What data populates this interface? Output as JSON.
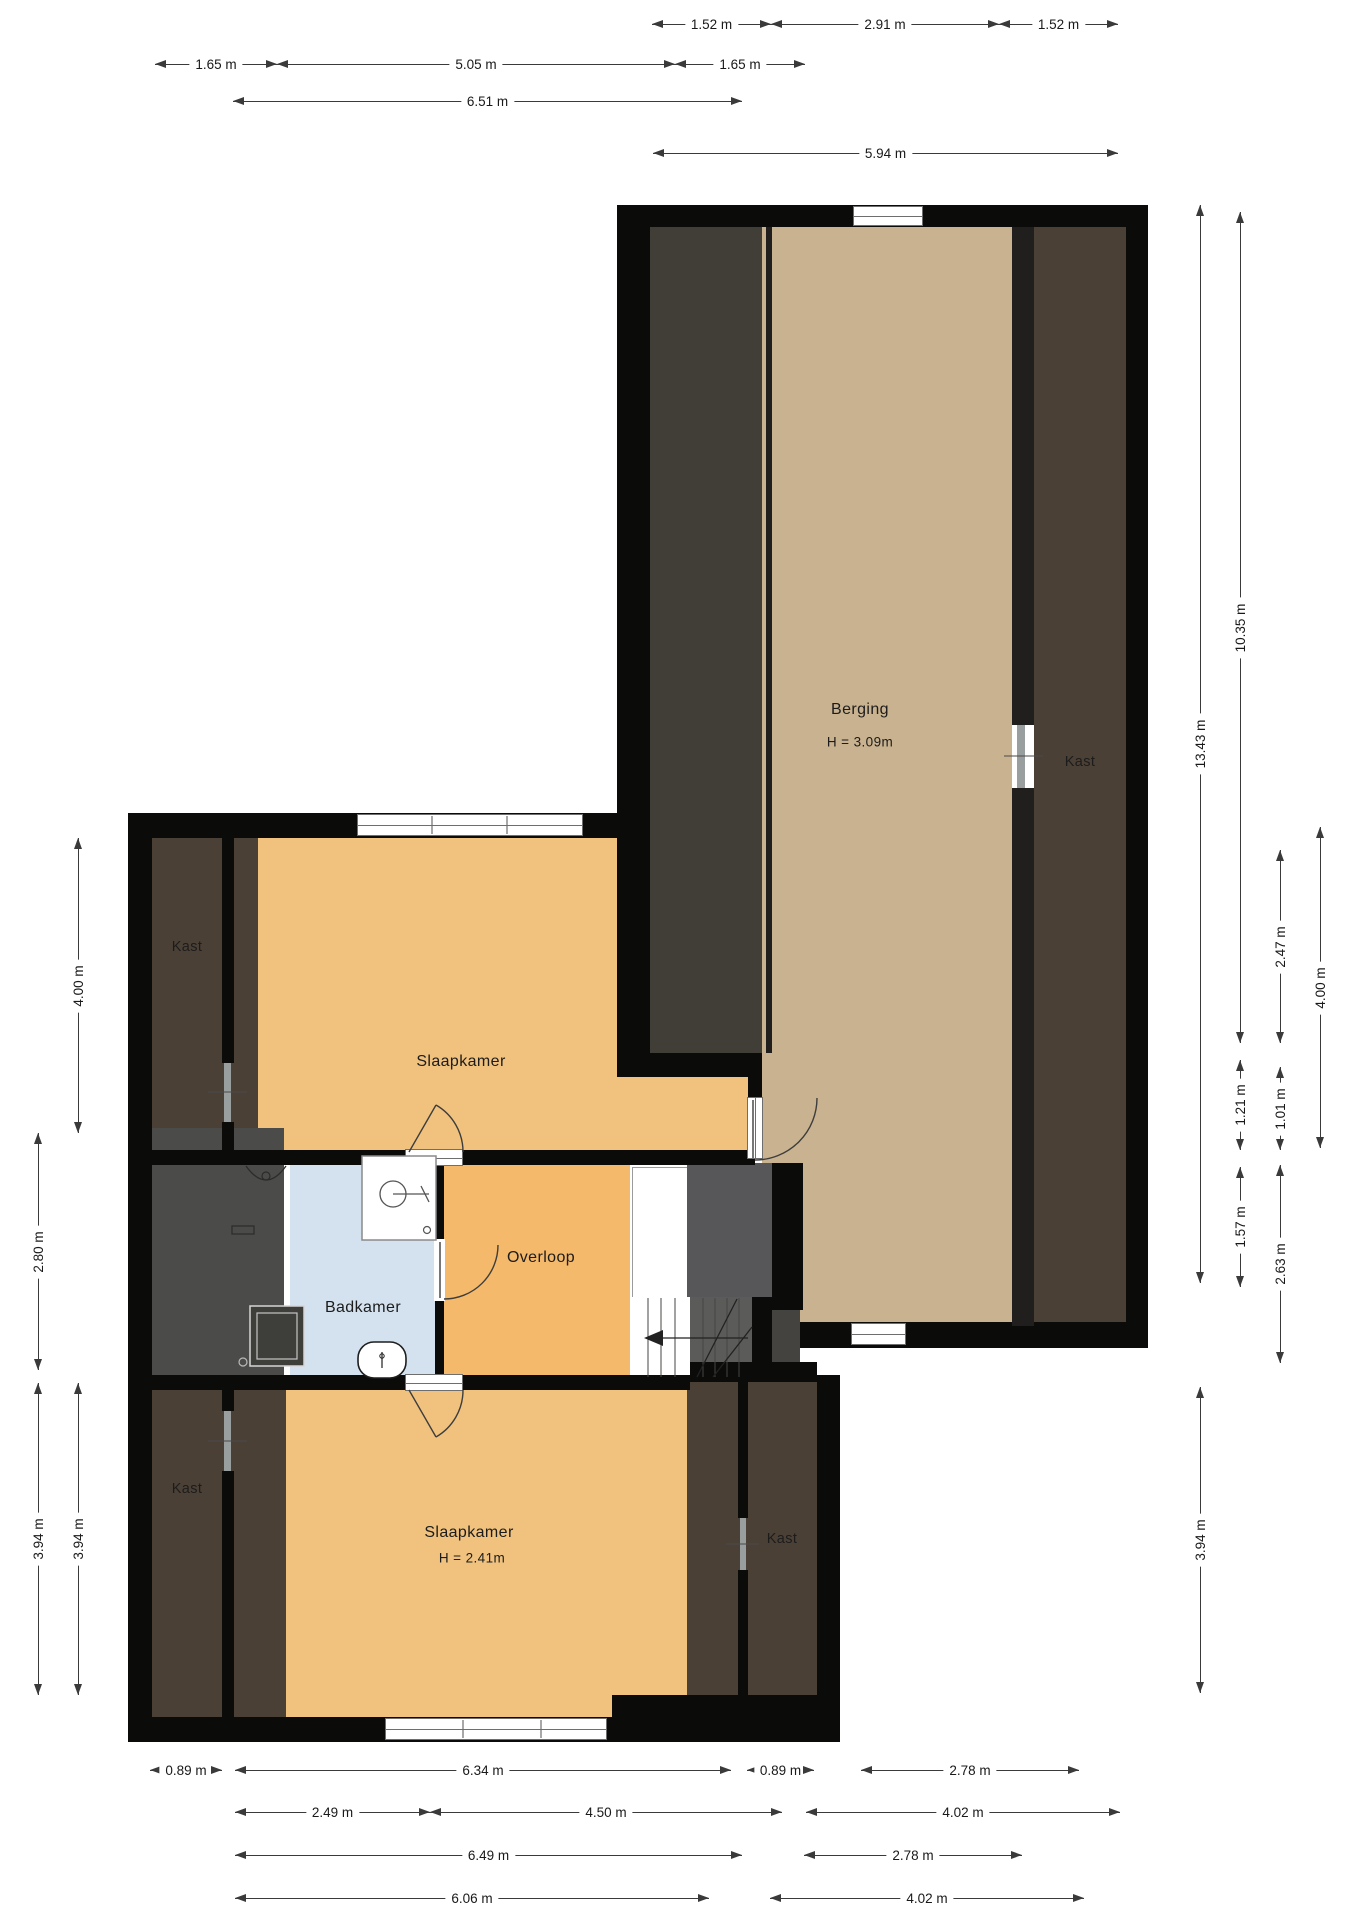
{
  "rooms": {
    "berging": {
      "label": "Berging",
      "height": "H = 3.09m"
    },
    "kast_berging": {
      "label": "Kast"
    },
    "kast_upper_left": {
      "label": "Kast"
    },
    "slaapkamer_upper": {
      "label": "Slaapkamer"
    },
    "badkamer": {
      "label": "Badkamer"
    },
    "overloop": {
      "label": "Overloop"
    },
    "slaapkamer_lower": {
      "label": "Slaapkamer",
      "height": "H = 2.41m"
    },
    "kast_lower_left": {
      "label": "Kast"
    },
    "kast_lower_right": {
      "label": "Kast"
    }
  },
  "colors": {
    "wall": "#0b0b0a",
    "bedroom_floor": "#F0C27E",
    "overloop_floor": "#F4B96B",
    "berging_floor": "#C9B28F",
    "badkamer_floor": "#D4E2EF",
    "kast_floor": "#4B4036",
    "berging_strip": "#413E38",
    "gray_strip": "#4B4B49",
    "void_gray": "#57575A",
    "dim": "#3a3a3a",
    "label": "#1c1c1c"
  },
  "dimensions": [
    {
      "label": "1.52 m",
      "orient": "h",
      "x": 652,
      "y": 24,
      "len": 119
    },
    {
      "label": "2.91 m",
      "orient": "h",
      "x": 771,
      "y": 24,
      "len": 228
    },
    {
      "label": "1.52 m",
      "orient": "h",
      "x": 999,
      "y": 24,
      "len": 119
    },
    {
      "label": "1.65 m",
      "orient": "h",
      "x": 155,
      "y": 64,
      "len": 122
    },
    {
      "label": "5.05 m",
      "orient": "h",
      "x": 277,
      "y": 64,
      "len": 398
    },
    {
      "label": "1.65 m",
      "orient": "h",
      "x": 675,
      "y": 64,
      "len": 130
    },
    {
      "label": "6.51 m",
      "orient": "h",
      "x": 233,
      "y": 101,
      "len": 509
    },
    {
      "label": "5.94 m",
      "orient": "h",
      "x": 653,
      "y": 153,
      "len": 465
    },
    {
      "label": "0.89 m",
      "orient": "h",
      "x": 150,
      "y": 1770,
      "len": 72
    },
    {
      "label": "6.34 m",
      "orient": "h",
      "x": 235,
      "y": 1770,
      "len": 496
    },
    {
      "label": "0.89 m",
      "orient": "h",
      "x": 747,
      "y": 1770,
      "len": 67
    },
    {
      "label": "2.78 m",
      "orient": "h",
      "x": 861,
      "y": 1770,
      "len": 218
    },
    {
      "label": "2.49 m",
      "orient": "h",
      "x": 235,
      "y": 1812,
      "len": 195
    },
    {
      "label": "4.50 m",
      "orient": "h",
      "x": 430,
      "y": 1812,
      "len": 352
    },
    {
      "label": "4.02 m",
      "orient": "h",
      "x": 806,
      "y": 1812,
      "len": 314
    },
    {
      "label": "6.49 m",
      "orient": "h",
      "x": 235,
      "y": 1855,
      "len": 507
    },
    {
      "label": "2.78 m",
      "orient": "h",
      "x": 804,
      "y": 1855,
      "len": 218
    },
    {
      "label": "6.06 m",
      "orient": "h",
      "x": 235,
      "y": 1898,
      "len": 474
    },
    {
      "label": "4.02 m",
      "orient": "h",
      "x": 770,
      "y": 1898,
      "len": 314
    },
    {
      "label": "4.00 m",
      "orient": "v",
      "x": 78,
      "y": 838,
      "len": 295
    },
    {
      "label": "2.80 m",
      "orient": "v",
      "x": 38,
      "y": 1133,
      "len": 237
    },
    {
      "label": "3.94 m",
      "orient": "v",
      "x": 38,
      "y": 1383,
      "len": 312
    },
    {
      "label": "3.94 m",
      "orient": "v",
      "x": 78,
      "y": 1383,
      "len": 312
    },
    {
      "label": "13.43 m",
      "orient": "v",
      "x": 1200,
      "y": 205,
      "len": 1078
    },
    {
      "label": "10.35 m",
      "orient": "v",
      "x": 1240,
      "y": 212,
      "len": 831
    },
    {
      "label": "2.47 m",
      "orient": "v",
      "x": 1280,
      "y": 850,
      "len": 193
    },
    {
      "label": "4.00 m",
      "orient": "v",
      "x": 1320,
      "y": 827,
      "len": 321
    },
    {
      "label": "1.21 m",
      "orient": "v",
      "x": 1240,
      "y": 1060,
      "len": 90
    },
    {
      "label": "1.01 m",
      "orient": "v",
      "x": 1280,
      "y": 1067,
      "len": 83
    },
    {
      "label": "1.57 m",
      "orient": "v",
      "x": 1240,
      "y": 1167,
      "len": 120
    },
    {
      "label": "2.63 m",
      "orient": "v",
      "x": 1280,
      "y": 1165,
      "len": 198
    },
    {
      "label": "3.94 m",
      "orient": "v",
      "x": 1200,
      "y": 1387,
      "len": 306
    }
  ]
}
